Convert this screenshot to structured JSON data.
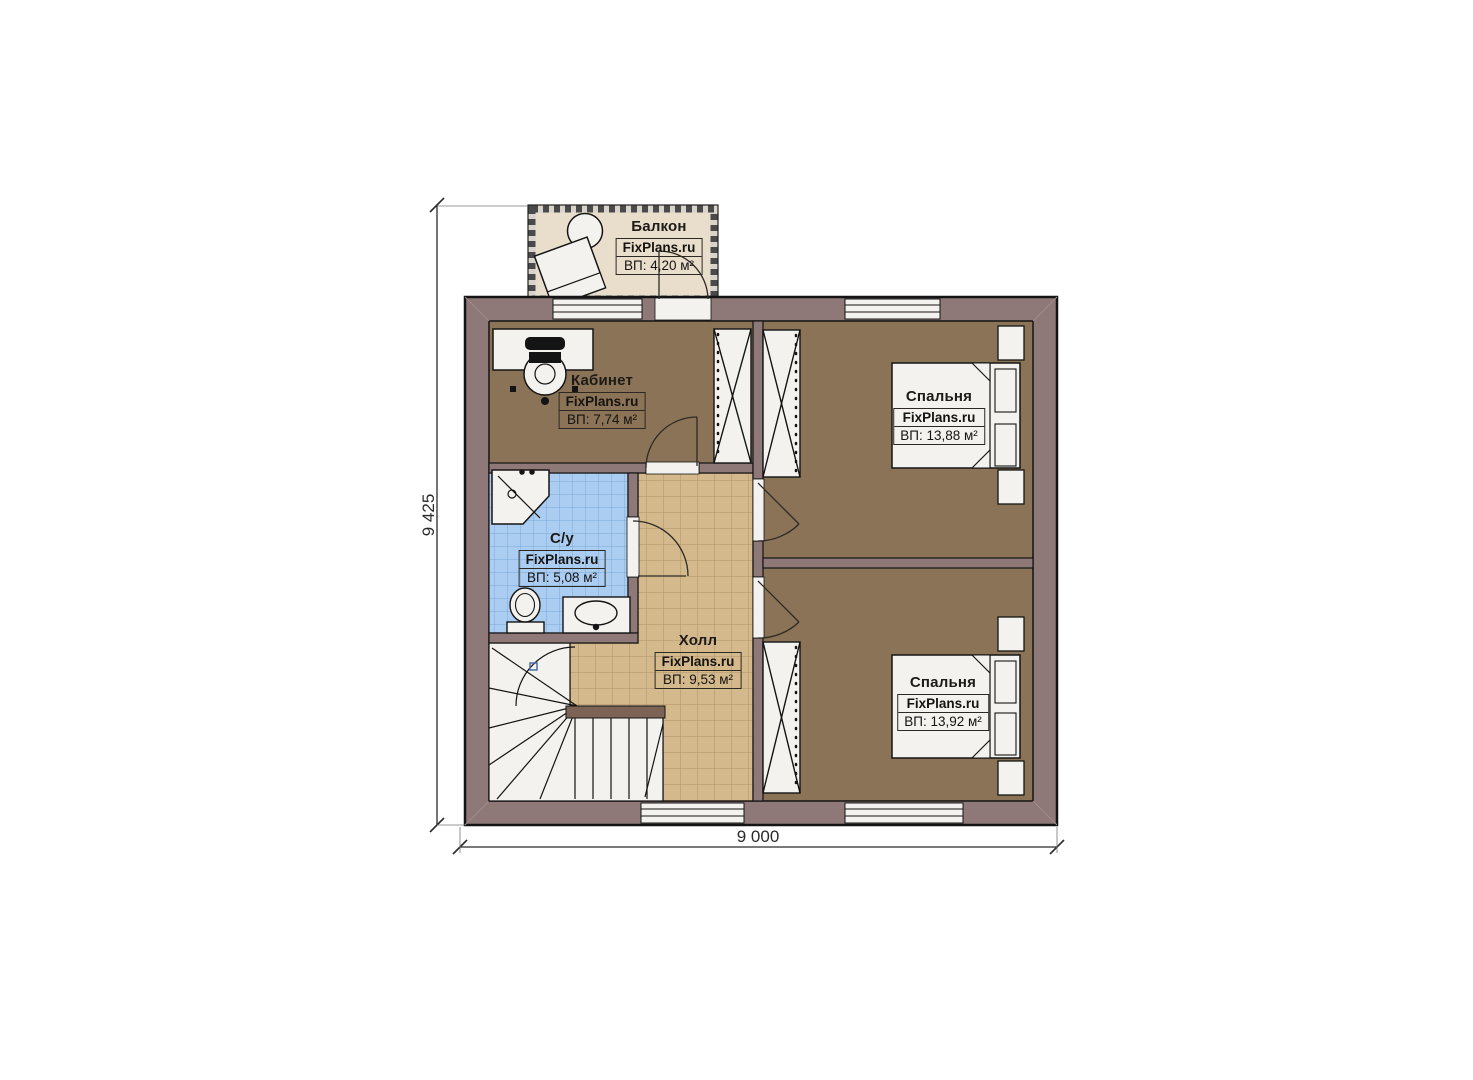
{
  "watermark": "FixPlans.ru",
  "dimensions": {
    "height_label": "9 425",
    "width_label": "9 000"
  },
  "rooms": [
    {
      "id": "balcony",
      "name": "Балкон",
      "area": "ВП: 4,20 м²"
    },
    {
      "id": "office",
      "name": "Кабинет",
      "area": "ВП: 7,74 м²"
    },
    {
      "id": "bedroom-top",
      "name": "Спальня",
      "area": "ВП: 13,88 м²"
    },
    {
      "id": "bathroom",
      "name": "С/у",
      "area": "ВП: 5,08 м²"
    },
    {
      "id": "hall",
      "name": "Холл",
      "area": "ВП: 9,53 м²"
    },
    {
      "id": "bedroom-bottom",
      "name": "Спальня",
      "area": "ВП: 13,92 м²"
    }
  ],
  "colors": {
    "wall": "#8e7878",
    "floor_wood": "#8a7356",
    "floor_hall": "#d3b98c",
    "floor_bath": "#aacdf1",
    "floor_balcony": "#e9decb",
    "tile_line_hall": "#b2946a",
    "tile_line_bath": "#7fa9d6"
  }
}
